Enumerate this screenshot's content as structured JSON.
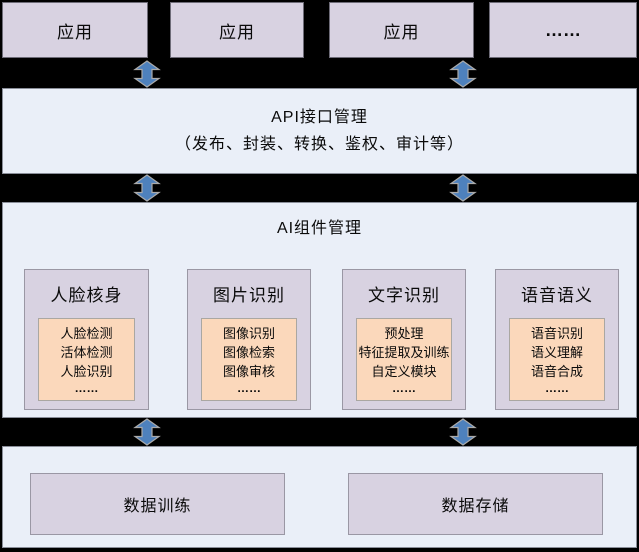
{
  "diagram": {
    "app_layer": {
      "boxes": [
        "应用",
        "应用",
        "应用",
        "……"
      ]
    },
    "api_layer": {
      "title": "API接口管理",
      "subtitle": "（发布、封装、转换、鉴权、审计等）"
    },
    "ai_layer": {
      "title": "AI组件管理",
      "modules": [
        {
          "title": "人脸核身",
          "items": [
            "人脸检测",
            "活体检测",
            "人脸识别",
            "……"
          ]
        },
        {
          "title": "图片识别",
          "items": [
            "图像识别",
            "图像检索",
            "图像审核",
            "……"
          ]
        },
        {
          "title": "文字识别",
          "items": [
            "预处理",
            "特征提取及训练",
            "自定义模块",
            "……"
          ]
        },
        {
          "title": "语音语义",
          "items": [
            "语音识别",
            "语义理解",
            "语音合成",
            "……"
          ]
        }
      ]
    },
    "data_layer": {
      "boxes": [
        "数据训练",
        "数据存储"
      ]
    },
    "icons": {
      "connector": "double-headed-vertical-arrow"
    },
    "colors": {
      "background": "#000000",
      "lavender_box": "#D8D2E1",
      "light_blue_section": "#EAEFF8",
      "orange_box": "#FBD8BB",
      "arrow_blue": "#4E81BD",
      "arrow_outline": "#ABABAB",
      "border_gray": "#8A8E99"
    }
  }
}
